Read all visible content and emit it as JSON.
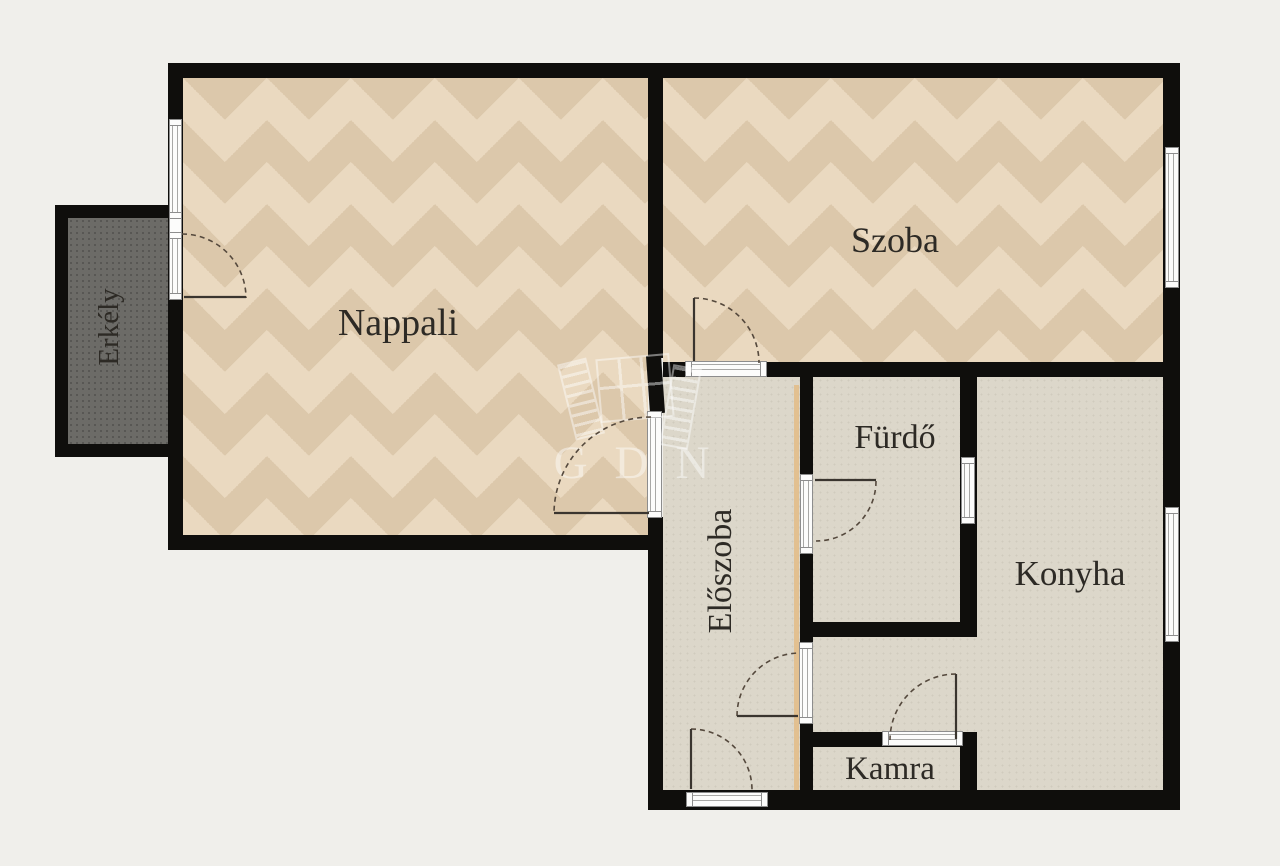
{
  "labels": {
    "nappali": "Nappali",
    "szoba": "Szoba",
    "erkely": "Erkély",
    "eloszoba": "Előszoba",
    "furdo": "Fürdő",
    "konyha": "Konyha",
    "kamra": "Kamra"
  },
  "watermark": {
    "text": "GDN"
  },
  "colors": {
    "background": "#f0efeb",
    "wall": "#0f0e0c",
    "parquet_base": "#e7d7bd",
    "parquet_dark": "#dcc8ab",
    "parquet_light": "#ead9c0",
    "hard_floor": "#dcd7ca",
    "balcony_floor": "#6c6b67",
    "frame_border": "#8d8d8d",
    "accent_line": "#e3bc86",
    "label": "#2d2a25"
  }
}
